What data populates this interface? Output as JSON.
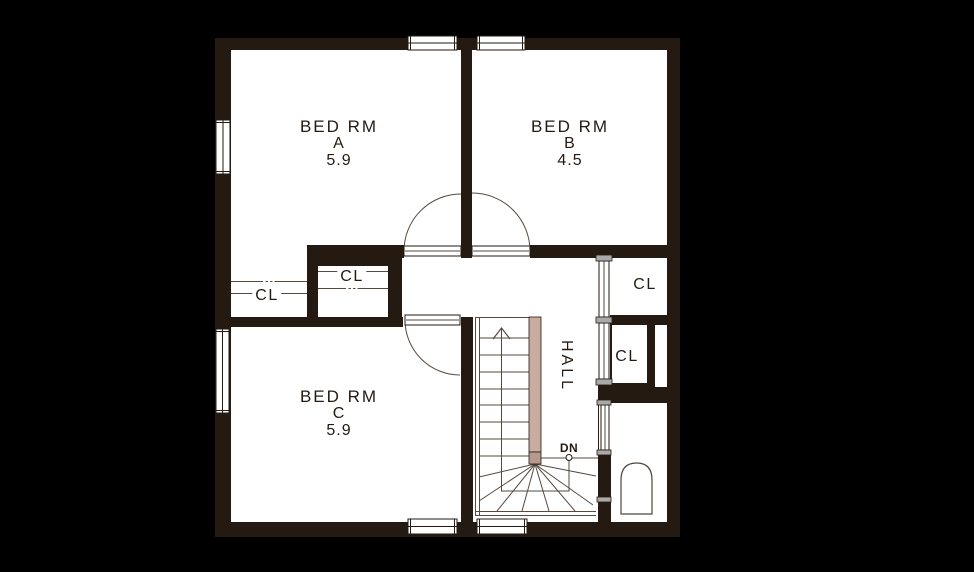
{
  "colors": {
    "background": "#000000",
    "wall": "#241a12",
    "floor": "#ffffff",
    "thin_line": "#56493f",
    "stair_rail": "#c9aca0",
    "stair_rail_cap": "#b79a8c",
    "door_end_cap": "#a9a9a9"
  },
  "rooms": {
    "bed_a": {
      "name": "BED RM",
      "letter": "A",
      "area": "5.9"
    },
    "bed_b": {
      "name": "BED RM",
      "letter": "B",
      "area": "4.5"
    },
    "bed_c": {
      "name": "BED RM",
      "letter": "C",
      "area": "5.9"
    },
    "hall": {
      "name": "HALL"
    }
  },
  "closets": [
    {
      "label": "CL"
    },
    {
      "label": "CL"
    },
    {
      "label": "CL"
    },
    {
      "label": "CL"
    }
  ],
  "stairs": {
    "down_label": "DN"
  }
}
